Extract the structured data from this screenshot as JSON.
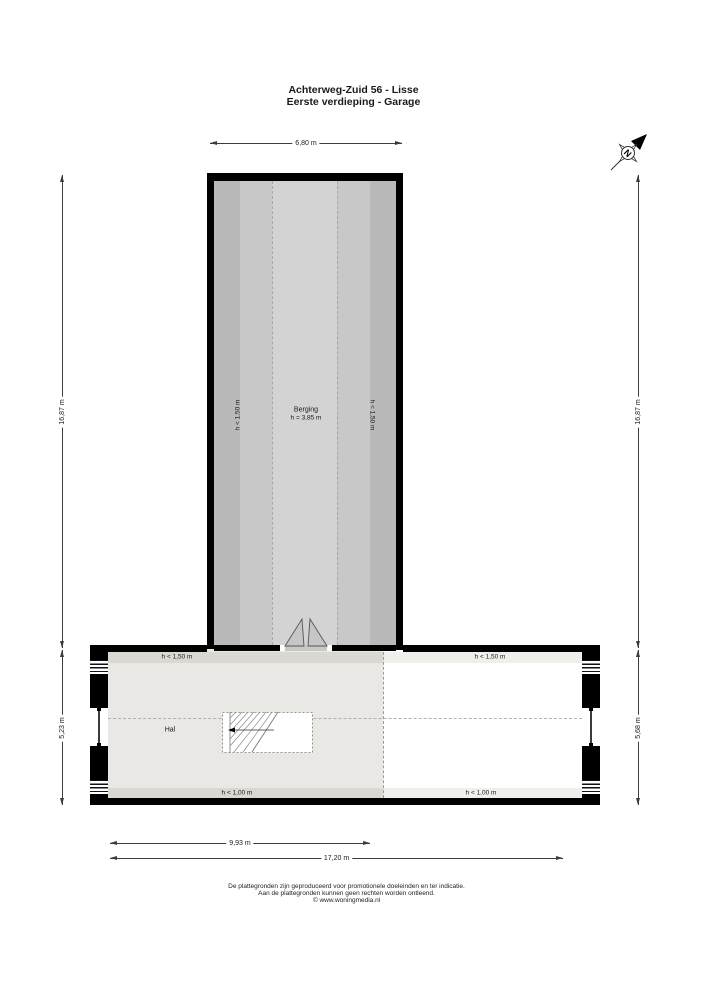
{
  "title": {
    "line1": "Achterweg-Zuid 56 - Lisse",
    "line2": "Eerste verdieping - Garage"
  },
  "compass": {
    "label": "N"
  },
  "rooms": {
    "berging": {
      "name": "Berging",
      "ceiling_height": "h = 3,85 m",
      "left_clearance": "h < 1,50 m",
      "right_clearance": "h < 1,50 m"
    },
    "hal": {
      "name": "Hal",
      "top_clearance": "h < 1,50 m",
      "bottom_clearance": "h < 1,00 m"
    },
    "right_area": {
      "top_clearance": "h < 1,50 m",
      "bottom_clearance": "h < 1,00 m"
    }
  },
  "dimensions": {
    "top_width": "6,80 m",
    "left_upper": "16,87 m",
    "left_lower": "5,23 m",
    "right_upper": "16,87 m",
    "right_lower": "5,68 m",
    "bottom_inner": "9,93 m",
    "bottom_total": "17,20 m"
  },
  "footer": {
    "line1": "De plattegronden zijn geproduceerd voor promotionele doeleinden en ter indicatie.",
    "line2": "Aan de plattegronden kunnen geen rechten worden ontleend.",
    "line3": "© www.woningmedia.nl"
  },
  "colors": {
    "wall": "#000000",
    "berging_floor": "#c8c8c8",
    "berging_edge_band": "#b9b9b9",
    "berging_center_band": "#d3d3d3",
    "hal_floor": "#e9e8e4",
    "hal_band": "#d9d8d3",
    "right_floor": "#ffffff",
    "right_band": "#f0efeb",
    "dash_line": "#a8a8a8"
  }
}
